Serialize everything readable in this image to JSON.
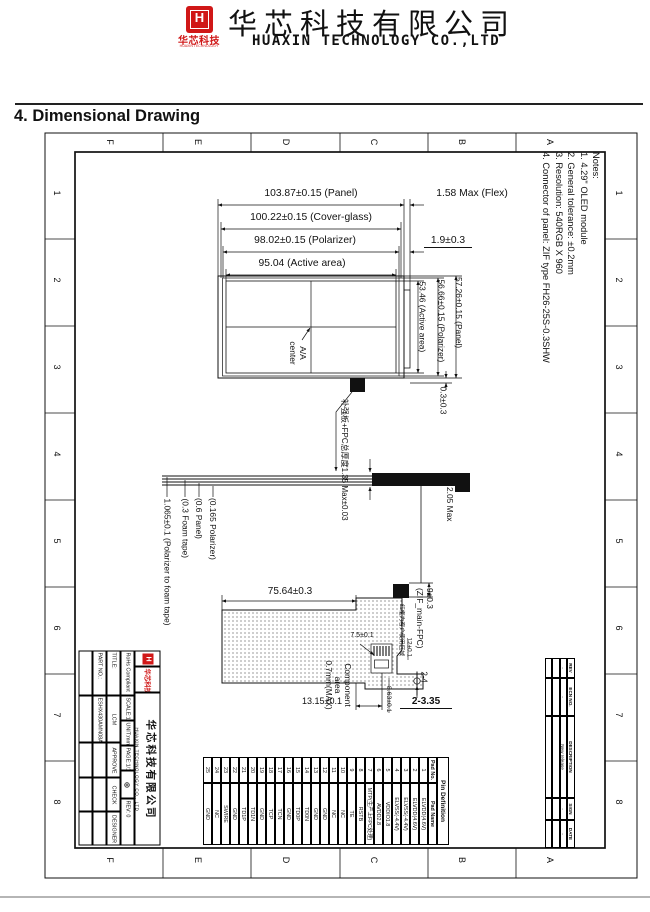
{
  "colors": {
    "brand_red": "#d01717",
    "line": "#111111"
  },
  "header": {
    "logo_letter": "H",
    "brand_cn": "华芯科技",
    "brand_en_small": "HUAXIN TECHNOLOGY",
    "company_cn": "华芯科技有限公司",
    "company_en": "HUAXIN TECHNOLOGY CO.,LTD"
  },
  "section_title": "4. Dimensional Drawing",
  "sheet": {
    "zone_letters": [
      "F",
      "E",
      "D",
      "C",
      "B",
      "A"
    ],
    "zone_numbers": [
      "1",
      "2",
      "3",
      "4",
      "5",
      "6",
      "7",
      "8"
    ],
    "notes": [
      "Notes:",
      "1. 4.29\" OLED module",
      "2. General tolerance: ±0.2mm",
      "3. Resolution: 540RGB X 960",
      "4. Connector of panel: ZIF type FH26-25S-0.3SHW"
    ]
  },
  "views": {
    "front": {
      "dim_panel_w": "103.87±0.15 (Panel)",
      "dim_flex": "1.58 Max (Flex)",
      "dim_cover_w": "100.22±0.15 (Cover-glass)",
      "dim_polarizer_w": "98.02±0.15 (Polarizer)",
      "dim_flex_w": "1.9±0.3",
      "dim_active_w": "95.04 (Active area)",
      "dim_active_h": "53.46 (Active area)",
      "dim_polarizer_h": "56.66±0.15 (Polarizer)",
      "dim_panel_h": "57.26±0.15 (Panel)",
      "aa_center": [
        "A/A",
        "center"
      ],
      "dim_offset": "0.3±0.3",
      "note_fpc_thickness": "补强板+FPC总厚度1.35 Max±0.03"
    },
    "side": {
      "layer_polarizer": "(0.165 Polarizer)",
      "layer_panel": "(0.6 Panel)",
      "layer_foam": "(0.3 Foam tape)",
      "layer_total": "1.065±0.1 (Polarizer to foam tape)",
      "dim_total": "2.05 Max"
    },
    "back": {
      "dim_width": "75.64±0.3",
      "component_area": [
        "Component",
        "area",
        "0.7mm(MAX)"
      ],
      "dim_connector": [
        "9±0.3",
        "(ZIF_main-FPC)"
      ],
      "note_red_frame": "红框为客户使用区域",
      "dim_7_5": "7.5±0.1",
      "dim_12": "12±0.1",
      "dim_2_4": "2-4",
      "dim_8_63": "8.63±0.1",
      "dim_13_15": "13.15±0.1",
      "dim_holes": "2-3.35"
    }
  },
  "pin_table": {
    "title": "Pin Definition",
    "col_no": "Pad No.",
    "col_name": "Pad Name",
    "pins": [
      {
        "no": "1",
        "name": "ELVDD(4.6V)"
      },
      {
        "no": "2",
        "name": "ELVDD(4.6V)"
      },
      {
        "no": "3",
        "name": "ELVSS(-4.4V)"
      },
      {
        "no": "4",
        "name": "ELVSS(-4.4V)"
      },
      {
        "no": "5",
        "name": "VDDIO1.8"
      },
      {
        "no": "6",
        "name": "AVDD2.8"
      },
      {
        "no": "7",
        "name": "MTP(生产上FPC处理)"
      },
      {
        "no": "8",
        "name": "RSTB"
      },
      {
        "no": "9",
        "name": "TE"
      },
      {
        "no": "10",
        "name": "NC"
      },
      {
        "no": "11",
        "name": "NC"
      },
      {
        "no": "12",
        "name": "GND"
      },
      {
        "no": "13",
        "name": "GND"
      },
      {
        "no": "14",
        "name": "TD0N"
      },
      {
        "no": "15",
        "name": "TD0P"
      },
      {
        "no": "16",
        "name": "GND"
      },
      {
        "no": "17",
        "name": "TCN"
      },
      {
        "no": "18",
        "name": "TCP"
      },
      {
        "no": "19",
        "name": "GND"
      },
      {
        "no": "20",
        "name": "TD1N"
      },
      {
        "no": "21",
        "name": "TD1P"
      },
      {
        "no": "22",
        "name": "GND"
      },
      {
        "no": "23",
        "name": "SWIRE"
      },
      {
        "no": "24",
        "name": "NC"
      },
      {
        "no": "25",
        "name": "GND"
      }
    ]
  },
  "title_block": {
    "logo_cn": "华芯科技",
    "company_cn": "华芯科技有限公司",
    "company_en": "HUAXIN TECHNOLOGY CO., LTD",
    "rohs": "RoHs Compliant",
    "scale": "SCALE:1/1",
    "unit": "UNIT:mm",
    "page": "PAGE:1/1",
    "projection_symbol": "⊕",
    "rev": "REV: 0",
    "title_label": "TITLE:",
    "title_value": "LCM",
    "approve": "APPROVE",
    "check": "CHECK",
    "designer": "DESIGNER",
    "part_label": "PART NO.:",
    "part_value": "ESHX430AMN08A"
  },
  "rev_table": {
    "headers": [
      "REV",
      "ECN NO.",
      "DESCRIPTION",
      "SIGN",
      "DATE"
    ],
    "rows": [
      [
        "-",
        "-",
        "New release",
        "-",
        "-"
      ],
      [
        "",
        "",
        "",
        "",
        ""
      ],
      [
        "",
        "",
        "",
        "",
        ""
      ]
    ]
  }
}
